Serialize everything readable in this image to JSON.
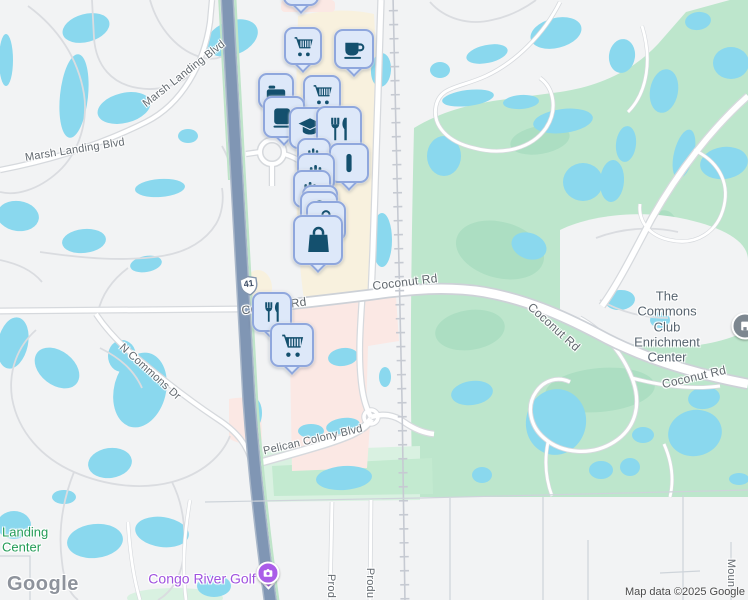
{
  "palette": {
    "land": "#f2f3f4",
    "water": "#8ad8ee",
    "green": "#bde6cc",
    "green_dark": "#a8ddc0",
    "green_pale": "#d9f1e1",
    "green_mid": "#c3ead0",
    "cream": "#f8f1de",
    "pink": "#fbe8e4",
    "road_minor": "#dadce0",
    "road_casing": "#d6d9dd",
    "major_casing": "#cdd1d7",
    "road_fill": "#ffffff",
    "highway": "#8096b4",
    "highway_casing": "#a9b7c9",
    "hwy_green": "#bfe4c9",
    "rail": "#c6cad2",
    "bound": "#ced4da",
    "marker_bg": "#dde8f9",
    "marker_border": "#8fa7dd",
    "marker_icon": "#14506e",
    "label": "#62696f",
    "poi_gray": "#57646f",
    "poi_green": "#249c57",
    "poi_purple": "#a052df",
    "congo_pin": "#aa5de8",
    "commons_pin": "#7d8790"
  },
  "texts": {
    "google_logo": "Google",
    "attribution": "Map data ©2025 Google",
    "route_shield": "41"
  },
  "road_labels": [
    {
      "text": "Marsh Landing Blvd",
      "x": 184,
      "y": 74,
      "rot": -38,
      "size": 11
    },
    {
      "text": "Marsh Landing Blvd",
      "x": 75,
      "y": 150,
      "rot": -9,
      "size": 11
    },
    {
      "text": "N Commons Dr",
      "x": 150,
      "y": 372,
      "rot": 42,
      "size": 11
    },
    {
      "text": "Coconut Rd",
      "x": 274,
      "y": 306,
      "rot": -8,
      "size": 12
    },
    {
      "text": "Coconut Rd",
      "x": 405,
      "y": 282,
      "rot": -7,
      "size": 12
    },
    {
      "text": "Coconut Rd",
      "x": 554,
      "y": 327,
      "rot": 42,
      "size": 12
    },
    {
      "text": "Coconut Rd",
      "x": 694,
      "y": 377,
      "rot": -13,
      "size": 12
    },
    {
      "text": "Pelican Colony Blvd",
      "x": 313,
      "y": 440,
      "rot": -13,
      "size": 11
    },
    {
      "text": "Prod",
      "x": 331,
      "y": 586,
      "rot": 90,
      "size": 11
    },
    {
      "text": "Produ",
      "x": 370,
      "y": 583,
      "rot": 90,
      "size": 11
    },
    {
      "text": "Moun",
      "x": 731,
      "y": 573,
      "rot": 90,
      "size": 11
    }
  ],
  "poi_labels": [
    {
      "name": "commons-club-label",
      "lines": [
        "The Commons Club",
        "Enrichment Center"
      ],
      "x": 667,
      "y": 327,
      "color_key": "poi_gray",
      "size": 13,
      "align": "center",
      "interactable": true
    },
    {
      "name": "congo-river-golf-label",
      "lines": [
        "Congo River Golf"
      ],
      "x": 202,
      "y": 579,
      "color_key": "poi_purple",
      "size": 14,
      "align": "center",
      "interactable": true
    },
    {
      "name": "landing-center-label",
      "lines": [
        "Landing",
        "Center"
      ],
      "x": 2,
      "y": 540,
      "color_key": "poi_green",
      "size": 13,
      "align": "left",
      "interactable": true
    }
  ],
  "markers": [
    {
      "icon": "shopping-cart-icon",
      "x": 301,
      "y": -12,
      "s": 36
    },
    {
      "icon": "shopping-cart-icon",
      "x": 303,
      "y": 46,
      "s": 38
    },
    {
      "icon": "coffee-cup-icon",
      "x": 354,
      "y": 49,
      "s": 40
    },
    {
      "icon": "bed-icon",
      "x": 276,
      "y": 91,
      "s": 36
    },
    {
      "icon": "shopping-cart-icon",
      "x": 322,
      "y": 94,
      "s": 38
    },
    {
      "icon": "coffee-mug-icon",
      "x": 284,
      "y": 117,
      "s": 42
    },
    {
      "icon": "graduation-cap-icon",
      "x": 310,
      "y": 128,
      "s": 42
    },
    {
      "icon": "restaurant-icon",
      "x": 339,
      "y": 129,
      "s": 46
    },
    {
      "icon": "bottles-icon",
      "x": 314,
      "y": 155,
      "s": 34
    },
    {
      "icon": "bottle-icon",
      "x": 349,
      "y": 163,
      "s": 40
    },
    {
      "icon": "bottles-icon",
      "x": 316,
      "y": 172,
      "s": 38
    },
    {
      "icon": "bottles-dot-icon",
      "x": 312,
      "y": 189,
      "s": 38
    },
    {
      "icon": "bottles-icon",
      "x": 320,
      "y": 203,
      "s": 36
    },
    {
      "icon": "shopping-bag-icon",
      "x": 319,
      "y": 210,
      "s": 38
    },
    {
      "icon": "shopping-bag-icon",
      "x": 326,
      "y": 221,
      "s": 40
    },
    {
      "icon": "shopping-bag-icon",
      "x": 318,
      "y": 240,
      "s": 50
    },
    {
      "icon": "restaurant-icon",
      "x": 272,
      "y": 312,
      "s": 40
    },
    {
      "icon": "shopping-cart-icon",
      "x": 292,
      "y": 345,
      "s": 44
    }
  ]
}
